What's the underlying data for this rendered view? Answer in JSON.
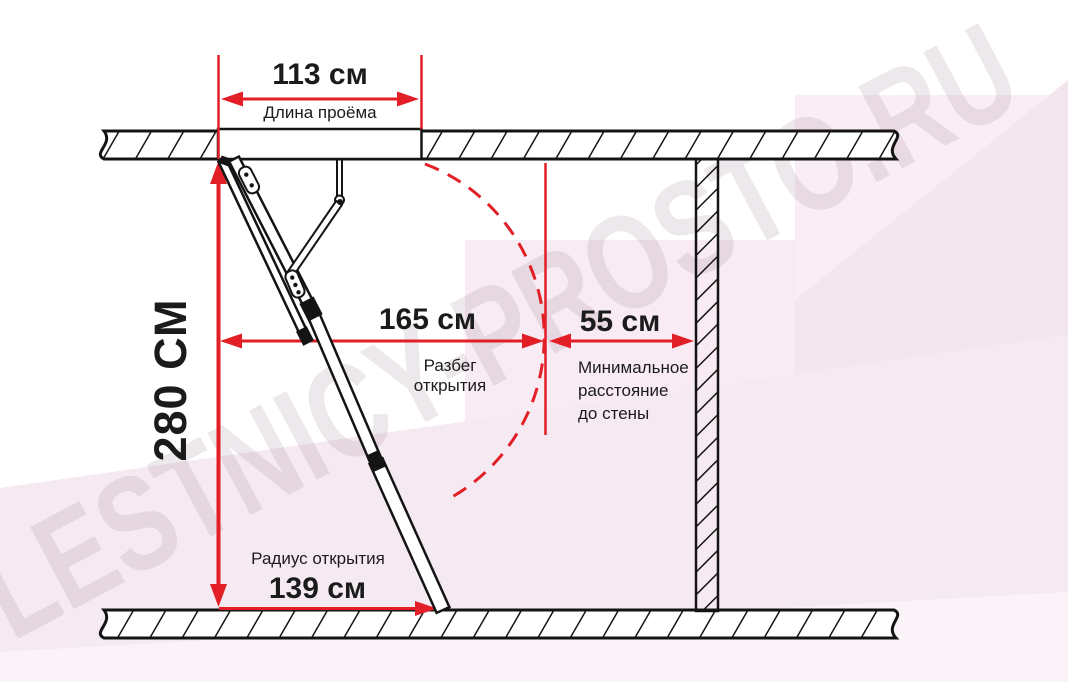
{
  "watermark": {
    "text": "LESTNICY-PROSTO.RU"
  },
  "colors": {
    "dimension_red": "#e21f26",
    "line_black": "#141414",
    "background_pink": "#f6eaf2"
  },
  "diagram": {
    "opening": {
      "value": "113 см",
      "label": "Длина проёма"
    },
    "ceiling_height": {
      "value": "280 СМ"
    },
    "swing_run": {
      "value": "165 см",
      "label": "Разбег открытия"
    },
    "wall_clearance": {
      "value": "55 см",
      "label": "Минимальное\nрасстояние\nдо стены"
    },
    "opening_radius": {
      "value": "139 см",
      "label": "Радиус открытия"
    }
  }
}
